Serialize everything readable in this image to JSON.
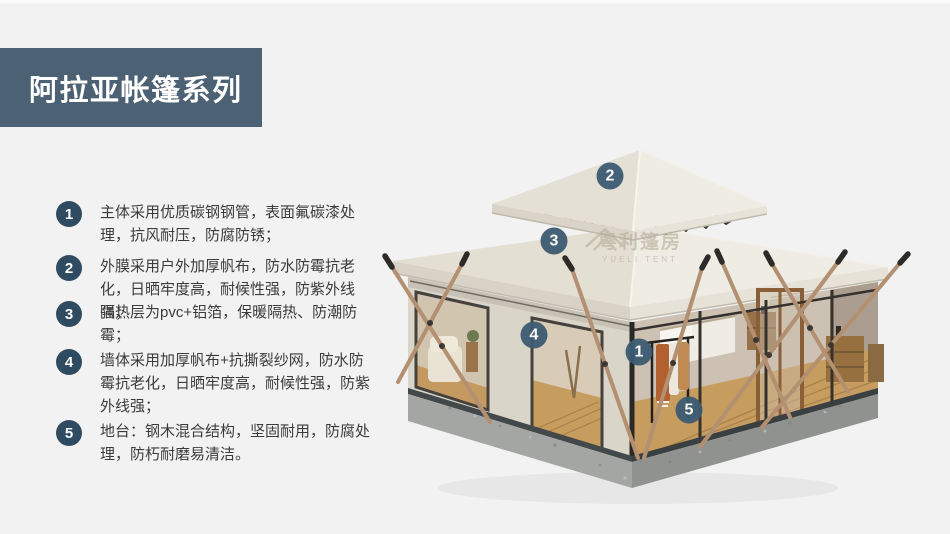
{
  "colors": {
    "bg": "#f2f2f3",
    "title-box": "#4d6175",
    "title-text": "#ffffff",
    "badge": "#2e4b61",
    "marker": "#3c5b72",
    "body-text": "#3b3b3b"
  },
  "header": {
    "title": "阿拉亚帐篷系列"
  },
  "features": {
    "items": [
      {
        "num": "1",
        "text": "主体采用优质碳钢钢管，表面氟碳漆处理，抗风耐压，防腐防锈；"
      },
      {
        "num": "2",
        "text": "外膜采用户外加厚帆布，防水防霉抗老化，日晒牢度高，耐候性强，防紫外线强；"
      },
      {
        "num": "3",
        "text": "隔热层为pvc+铝箔，保暖隔热、防潮防霉；"
      },
      {
        "num": "4",
        "text": "墙体采用加厚帆布+抗撕裂纱网，防水防霉抗老化，日晒牢度高，耐候性强，防紫外线强；"
      },
      {
        "num": "5",
        "text": "地台：钢木混合结构，坚固耐用，防腐处理，防朽耐磨易清洁。"
      }
    ]
  },
  "tent": {
    "marker_labels": {
      "m1": "1",
      "m2": "2",
      "m3": "3",
      "m4": "4",
      "m5": "5"
    },
    "watermark": {
      "cn": "粤利篷房",
      "en": "YUELI TENT"
    }
  }
}
